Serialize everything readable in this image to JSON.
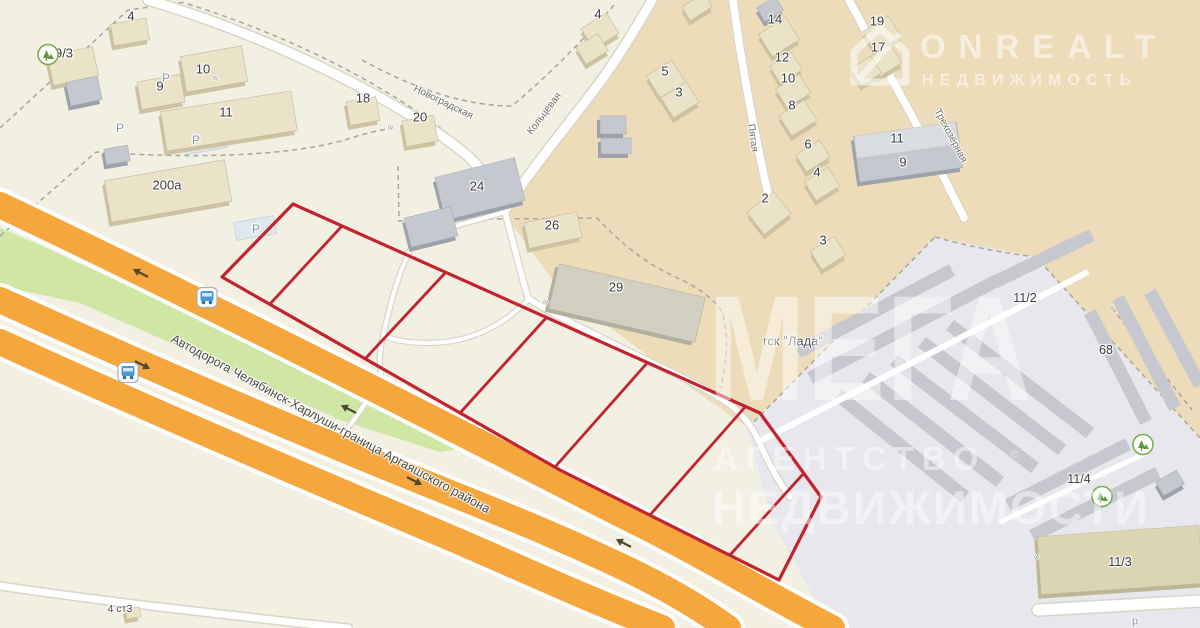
{
  "map": {
    "colors": {
      "land": "#f2efe3",
      "district_tan": "#ecdcb9",
      "industrial_gray": "#e7e7ed",
      "highway_orange": "#f5a63d",
      "greenery": "#cfe6a4",
      "plot_red": "#c2232e"
    },
    "plot": {
      "color": "#c2232e",
      "stroke_width": 3.2,
      "outline": [
        [
          293,
          204
        ],
        [
          760,
          413
        ],
        [
          821,
          497
        ],
        [
          779,
          580
        ],
        [
          560,
          470
        ],
        [
          222,
          277
        ]
      ],
      "hatch": [
        [
          270,
          304,
          342,
          226
        ],
        [
          365,
          359,
          446,
          272
        ],
        [
          460,
          413,
          546,
          318
        ],
        [
          555,
          467,
          648,
          362
        ],
        [
          650,
          515,
          746,
          406
        ],
        [
          730,
          555,
          804,
          473
        ]
      ]
    },
    "labels": [
      {
        "t": "4",
        "x": 131,
        "y": 16
      },
      {
        "t": "9/3",
        "x": 64,
        "y": 53
      },
      {
        "t": "10",
        "x": 203,
        "y": 69
      },
      {
        "t": "9",
        "x": 160,
        "y": 86
      },
      {
        "t": "11",
        "x": 226,
        "y": 112
      },
      {
        "t": "200а",
        "x": 167,
        "y": 185
      },
      {
        "t": "18",
        "x": 363,
        "y": 98
      },
      {
        "t": "20",
        "x": 420,
        "y": 117
      },
      {
        "t": "24",
        "x": 477,
        "y": 186
      },
      {
        "t": "26",
        "x": 552,
        "y": 225
      },
      {
        "t": "29",
        "x": 616,
        "y": 287
      },
      {
        "t": "4",
        "x": 598,
        "y": 14
      },
      {
        "t": "5",
        "x": 665,
        "y": 71
      },
      {
        "t": "3",
        "x": 679,
        "y": 92
      },
      {
        "t": "14",
        "x": 775,
        "y": 19
      },
      {
        "t": "12",
        "x": 782,
        "y": 57
      },
      {
        "t": "10",
        "x": 788,
        "y": 78
      },
      {
        "t": "8",
        "x": 792,
        "y": 105
      },
      {
        "t": "6",
        "x": 808,
        "y": 144
      },
      {
        "t": "4",
        "x": 817,
        "y": 172
      },
      {
        "t": "2",
        "x": 765,
        "y": 198
      },
      {
        "t": "3",
        "x": 823,
        "y": 240
      },
      {
        "t": "19",
        "x": 877,
        "y": 21
      },
      {
        "t": "17",
        "x": 878,
        "y": 47
      },
      {
        "t": "11",
        "x": 897,
        "y": 138
      },
      {
        "t": "9",
        "x": 903,
        "y": 162
      },
      {
        "t": "11/2",
        "x": 1025,
        "y": 298,
        "s": 12.5
      },
      {
        "t": "68",
        "x": 1106,
        "y": 350,
        "s": 12.5
      },
      {
        "t": "11/4",
        "x": 1079,
        "y": 479,
        "s": 12.5
      },
      {
        "t": "11/3",
        "x": 1120,
        "y": 562,
        "s": 12.5
      },
      {
        "t": "4 ст3",
        "x": 120,
        "y": 609,
        "s": 10.5,
        "c": "#4a4a4a"
      },
      {
        "t": "р",
        "x": 1135,
        "y": 622,
        "s": 11,
        "c": "#8f949b"
      },
      {
        "t": "гск \"Лада\"",
        "x": 793,
        "y": 341,
        "s": 13,
        "c": "#4f4f4f"
      },
      {
        "t": "Новоградская",
        "x": 443,
        "y": 103,
        "s": 10,
        "c": "#716e66",
        "a": 26
      },
      {
        "t": "Кольцевая",
        "x": 545,
        "y": 114,
        "s": 10,
        "c": "#716e66",
        "a": -53
      },
      {
        "t": "Пятая",
        "x": 752,
        "y": 138,
        "s": 10,
        "c": "#716e66",
        "a": 82
      },
      {
        "t": "Трехозёрная",
        "x": 950,
        "y": 136,
        "s": 10,
        "c": "#716e66",
        "a": 62
      },
      {
        "t": "Автодорога Челябинск-Харлуши-граница Аргаяшского района",
        "x": 172,
        "y": 338,
        "s": 12.5,
        "c": "#4c4c46",
        "a": 28.5,
        "anchor": "left"
      },
      {
        "t": "Р",
        "x": 166,
        "y": 78,
        "s": 12,
        "c": "#8d98a6"
      },
      {
        "t": "Р",
        "x": 120,
        "y": 128,
        "s": 12,
        "c": "#8d98a6"
      },
      {
        "t": "Р",
        "x": 196,
        "y": 140,
        "s": 12,
        "c": "#8d98a6"
      },
      {
        "t": "Р",
        "x": 256,
        "y": 229,
        "s": 12,
        "c": "#8d98a6"
      },
      {
        "t": "III",
        "x": 390,
        "y": 128,
        "s": 6,
        "c": "#8f8f8f",
        "a": 20
      },
      {
        "t": "III",
        "x": 545,
        "y": 303,
        "s": 6,
        "c": "#8f8f8f",
        "a": 25
      },
      {
        "t": "III",
        "x": 215,
        "y": 79,
        "s": 6,
        "c": "#8f8f8f",
        "a": 20
      },
      {
        "t": "III",
        "x": 1015,
        "y": 455,
        "s": 6,
        "c": "#8f8f8f",
        "a": -30
      },
      {
        "t": "III",
        "x": 1112,
        "y": 309,
        "s": 6,
        "c": "#8f8f8f",
        "a": -35
      },
      {
        "t": "III",
        "x": 1037,
        "y": 558,
        "s": 6,
        "c": "#8f8f8f",
        "a": -30
      }
    ],
    "icons": [
      {
        "type": "bus",
        "x": 207,
        "y": 300
      },
      {
        "type": "bus",
        "x": 128,
        "y": 375
      },
      {
        "type": "park",
        "x": 48,
        "y": 57
      },
      {
        "type": "park",
        "x": 1143,
        "y": 447
      },
      {
        "type": "park",
        "x": 1102,
        "y": 499
      },
      {
        "type": "arrow",
        "x": 142,
        "y": 271,
        "rot": 207
      },
      {
        "type": "arrow",
        "x": 141,
        "y": 367,
        "rot": 27
      },
      {
        "type": "arrow",
        "x": 350,
        "y": 407,
        "rot": 207
      },
      {
        "type": "arrow",
        "x": 413,
        "y": 483,
        "rot": 27
      },
      {
        "type": "arrow",
        "x": 625,
        "y": 541,
        "rot": 207
      }
    ],
    "watermark_logo": {
      "brand": "ONREALT",
      "tagline": "НЕДВИЖИМОСТЬ"
    },
    "watermark_big": {
      "line1": "МЕГА",
      "line2": "АГЕНТСТВО",
      "line3": "НЕДВИЖИМОСТИ"
    }
  }
}
